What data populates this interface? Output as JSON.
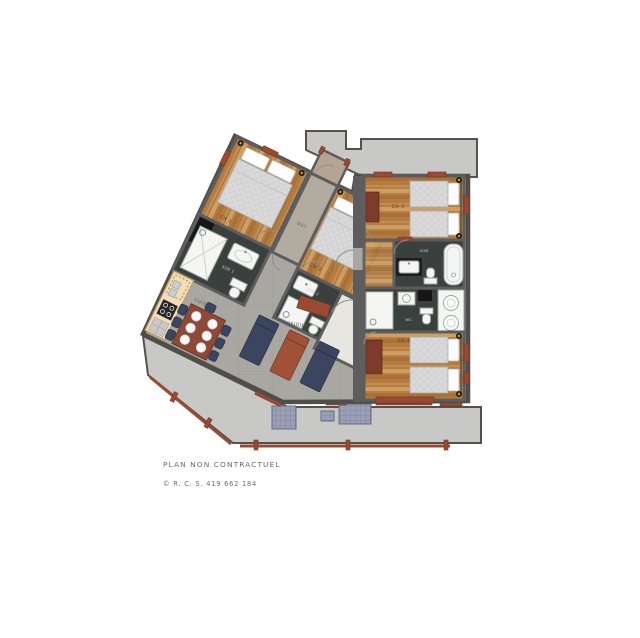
{
  "plan": {
    "rooms": {
      "ch1": "CH 1",
      "ch2": "CH 2",
      "ch3": "CH 3",
      "ch4": "CH 4",
      "dgt": "DGT",
      "cuisine": "CUISINE",
      "sejour": "SEJOUR",
      "sde1": "SDE 1",
      "sde2": "SDE 2",
      "sdb": "SDB",
      "wc": "WC"
    },
    "caption": {
      "line1": "PLAN NON CONTRACTUEL",
      "line2": "© R. C. S. 419 662 184"
    },
    "colors": {
      "wall": "#5d5d5d",
      "terrace": "#c8c8c6",
      "darkfloor": "#3a403d",
      "accent": "#9a4a32",
      "accent2": "#8d4a36",
      "navy": "#3c4560",
      "cream": "#f2ddb5",
      "woodbase": "#c28e50"
    }
  }
}
